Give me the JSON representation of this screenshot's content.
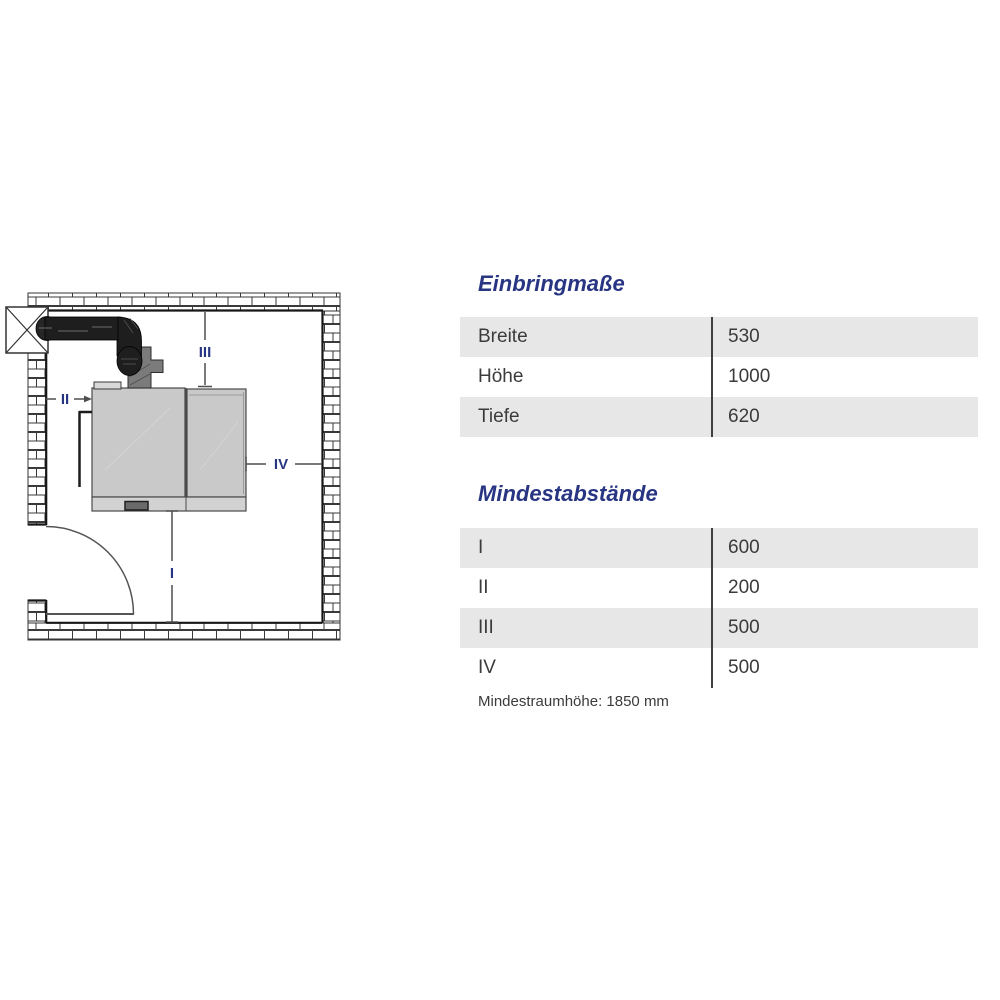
{
  "diagram": {
    "markers": {
      "i": "I",
      "ii": "II",
      "iii": "III",
      "iv": "IV"
    }
  },
  "sections": [
    {
      "title": "Einbringmaße",
      "rows": [
        {
          "label": "Breite",
          "value": "530"
        },
        {
          "label": "Höhe",
          "value": "1000"
        },
        {
          "label": "Tiefe",
          "value": "620"
        }
      ]
    },
    {
      "title": "Mindestabstände",
      "rows": [
        {
          "label": "I",
          "value": "600"
        },
        {
          "label": "II",
          "value": "200"
        },
        {
          "label": "III",
          "value": "500"
        },
        {
          "label": "IV",
          "value": "500"
        }
      ],
      "footnote": "Mindestraumhöhe: 1850 mm"
    }
  ],
  "colors": {
    "accent": "#283583",
    "row-gray": "#e7e7e7",
    "table-text": "#3b3b3b",
    "divider": "#3f3f3f",
    "wall-line": "#333333",
    "pipe-black": "#1e1e1e",
    "boiler-gray": "#c9c9c9"
  }
}
